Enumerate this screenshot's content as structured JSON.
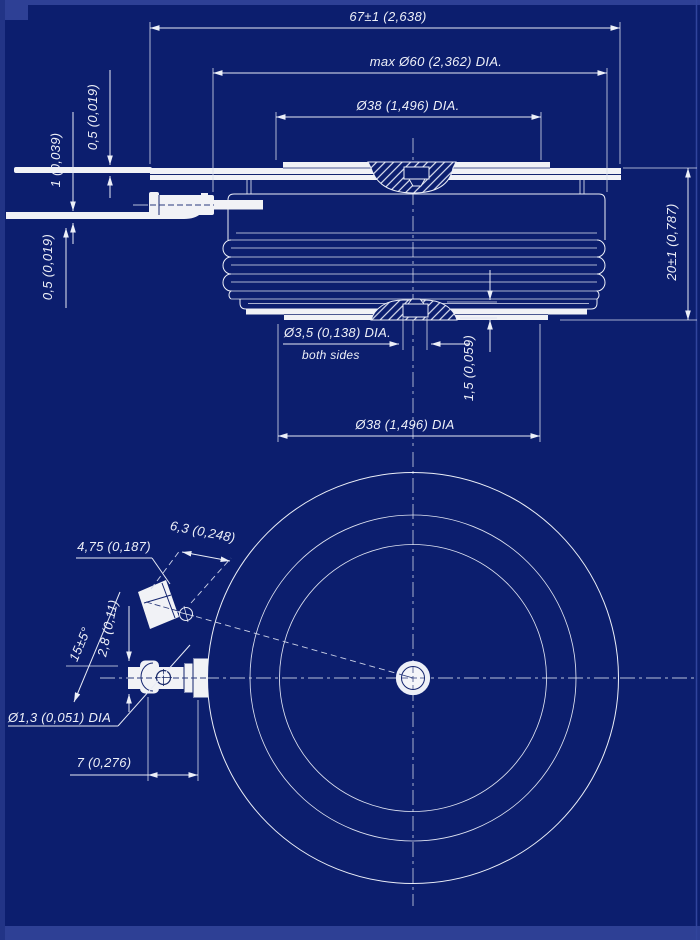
{
  "drawing": {
    "background_color": "#0c1e6e",
    "line_color": "#eceff8",
    "centerline_color": "#b9c0da",
    "frame_color": "#2e4095",
    "hatch_style": "diagonal-section-hatch"
  },
  "side_view": {
    "dims": {
      "overall_width": "67±1 (2,638)",
      "max_body_dia": "max Ø60 (2,362) DIA.",
      "pole_dia_top": "Ø38 (1,496) DIA.",
      "lead_thickness_upper": "0,5 (0,019)",
      "lead_spacing": "1 (0,039)",
      "lead_thickness_lower": "0,5 (0,019)",
      "height": "20±1 (0,787)",
      "gate_recess_dia": "Ø3,5 (0,138) DIA.",
      "gate_recess_note": "both sides",
      "recess_depth": "1,5 (0,059)",
      "pole_dia_bottom": "Ø38 (1,496) DIA"
    }
  },
  "bottom_view": {
    "dims": {
      "lug_face": "6,3 (0,248)",
      "lug_length": "4,75 (0,187)",
      "lead_angle": "15±5°",
      "lug_thickness": "2,8 (0,11)",
      "hole_dia": "Ø1,3 (0,051) DIA",
      "lead_offset": "7 (0,276)"
    }
  }
}
